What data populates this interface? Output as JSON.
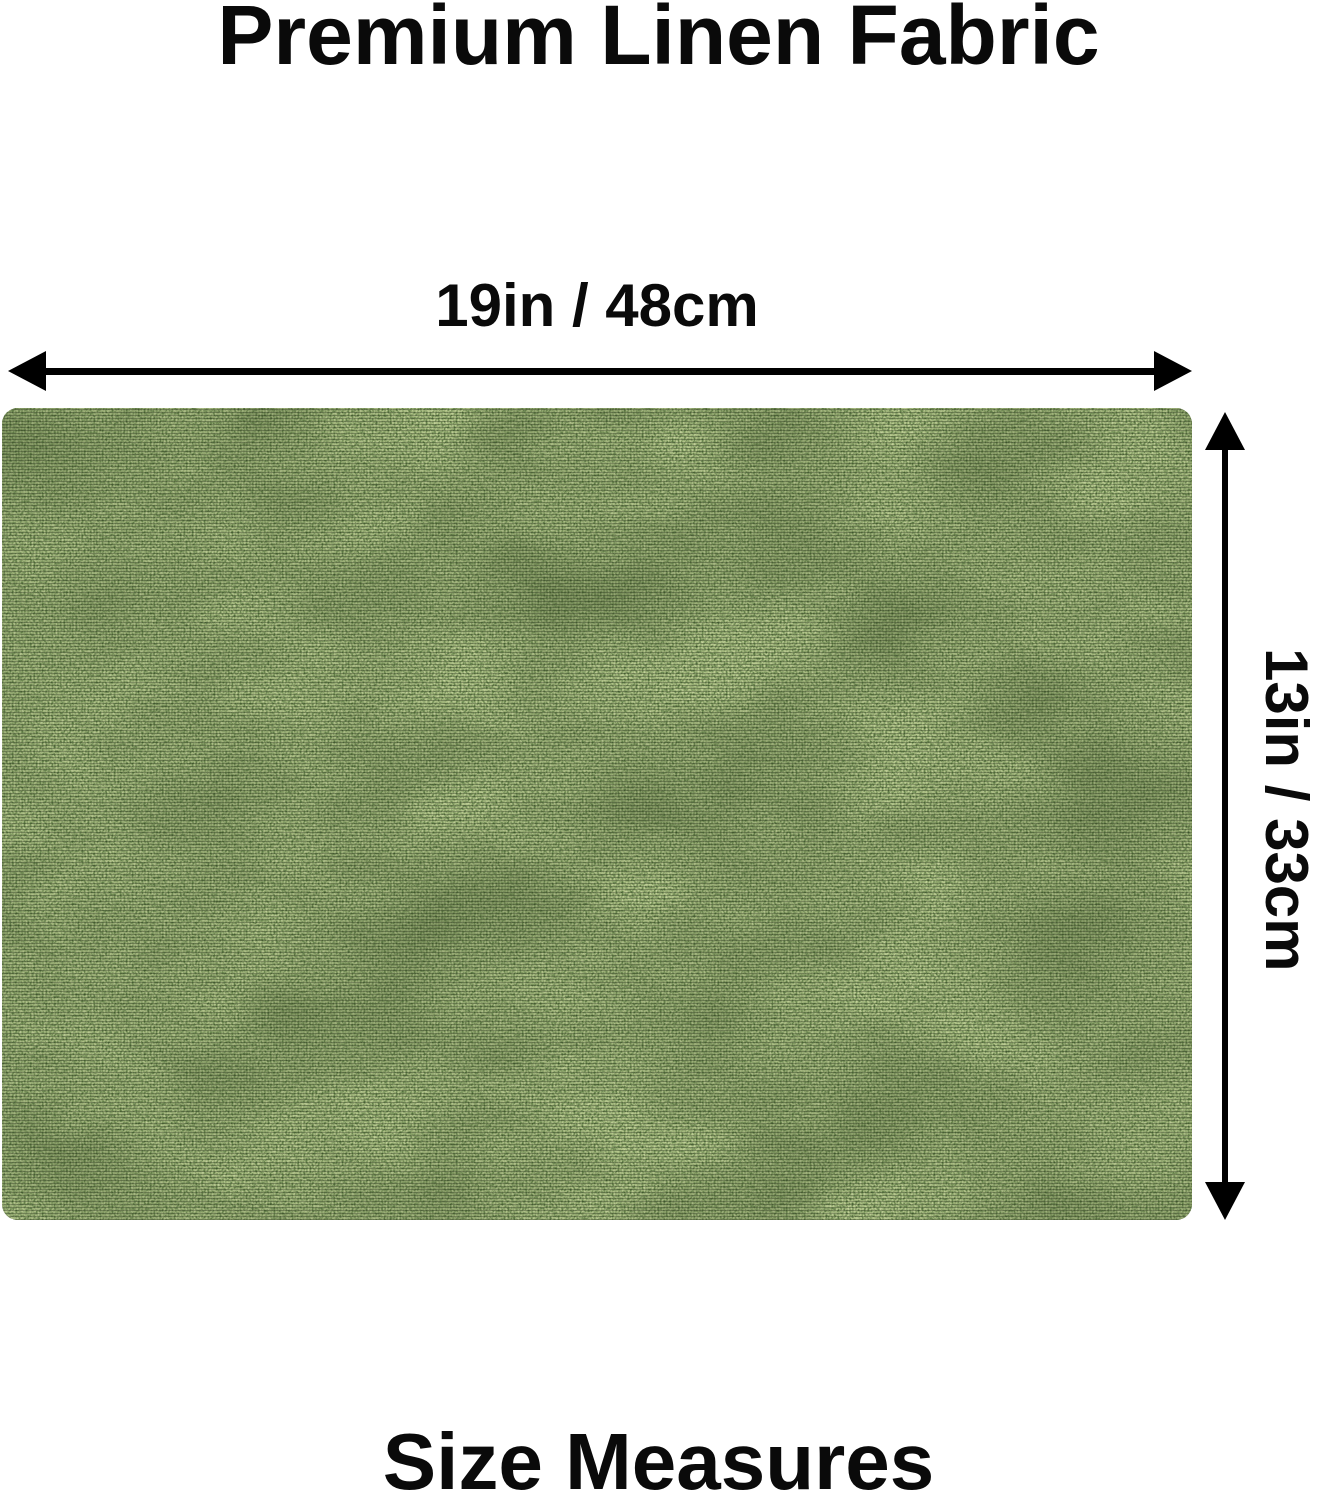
{
  "page": {
    "title": "Premium Linen Fabric",
    "footer": "Size Measures"
  },
  "dimensions": {
    "width": {
      "label": "19in / 48cm"
    },
    "height": {
      "label": "13in / 33cm"
    }
  },
  "fabric": {
    "base_color": "#4d6534",
    "light_thread_color": "#93a96c",
    "mid_thread_color": "#5a7240",
    "dark_thread_color": "#1c2811"
  },
  "colors": {
    "text": "#0a0a0a",
    "arrow": "#000000",
    "bg": "#ffffff"
  }
}
